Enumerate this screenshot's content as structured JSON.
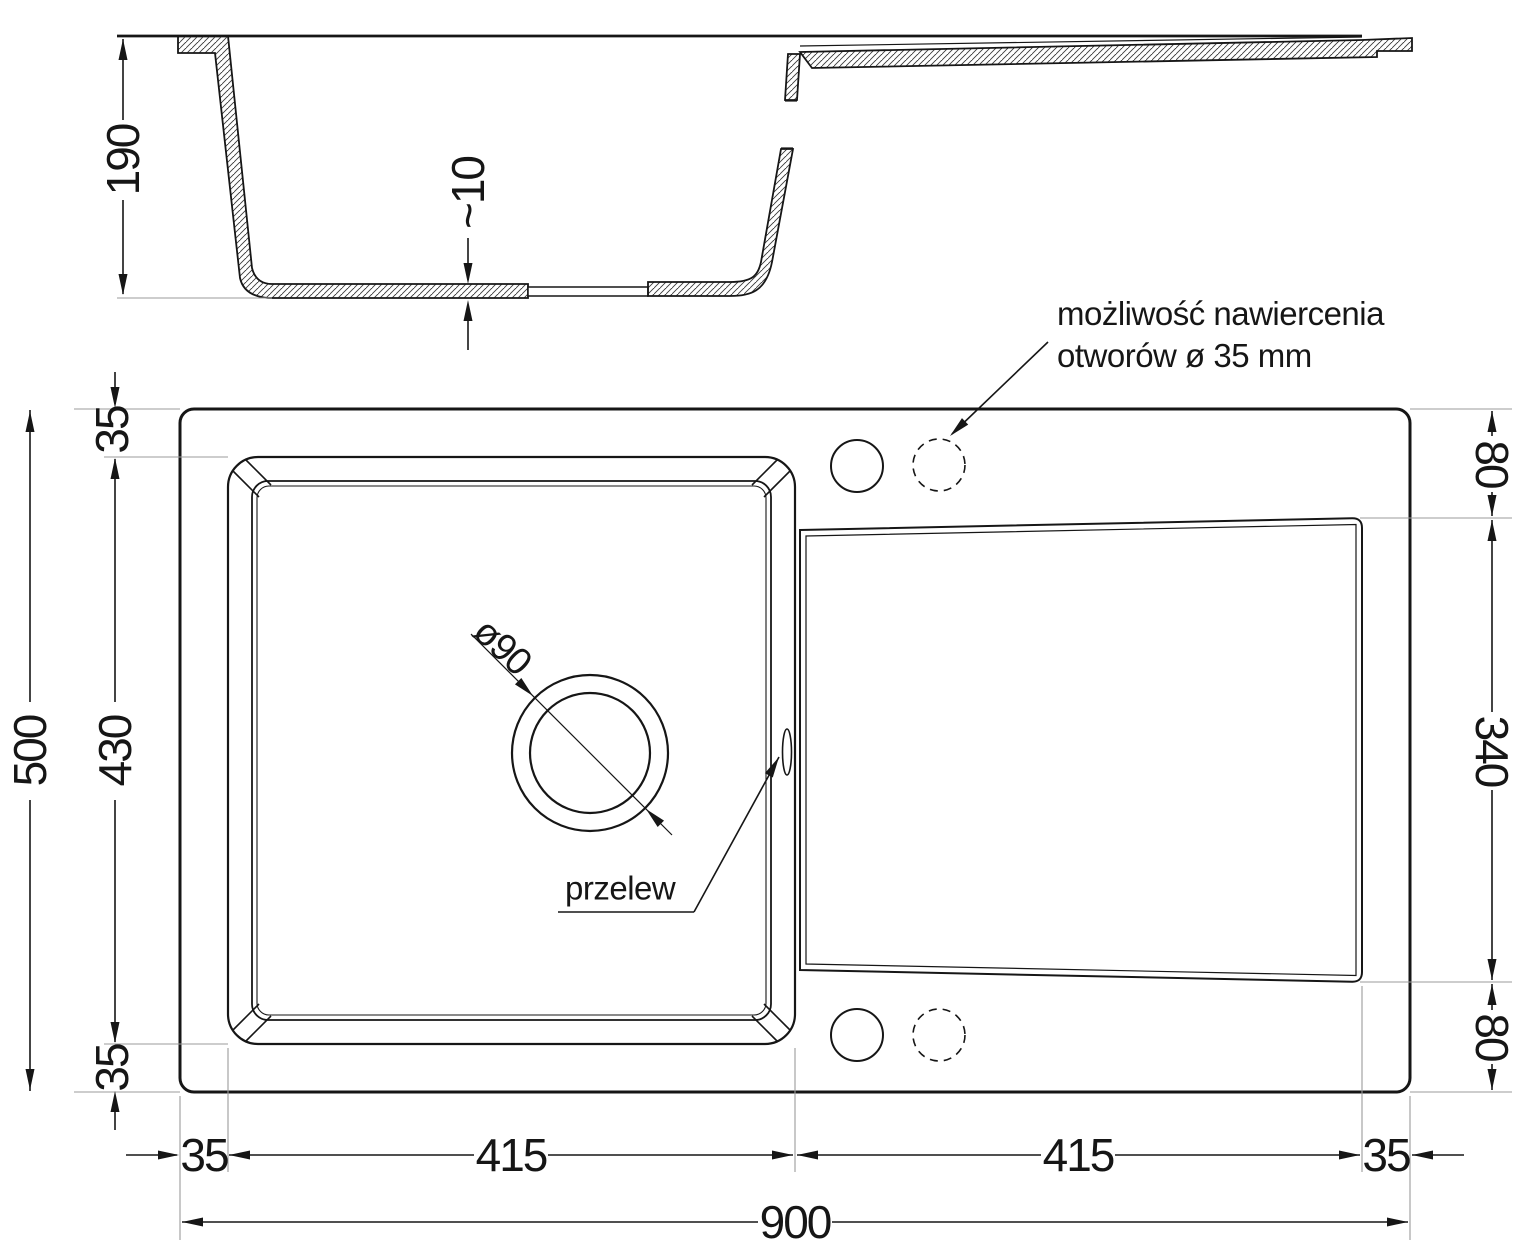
{
  "drawing": {
    "type": "sink-technical-drawing",
    "units": "mm",
    "dims": {
      "section_depth": "190",
      "section_bottom_thickness": "~10",
      "plan_total_depth": "500",
      "plan_rim_top": "35",
      "plan_bowl_depth": "430",
      "plan_rim_bottom": "35",
      "drainer_offset_top": "80",
      "drainer_height": "340",
      "drainer_offset_bottom": "80",
      "plan_margin_left": "35",
      "plan_bowl_width": "415",
      "plan_drainer_width": "415",
      "plan_margin_right": "35",
      "plan_total_width": "900",
      "drain_diameter": "ø90"
    },
    "labels": {
      "drill_note_line1": "możliwość nawiercenia",
      "drill_note_line2": "otworów ø 35 mm",
      "overflow": "przelew"
    },
    "colors": {
      "line": "#161616",
      "extension_line": "#9b9b9b",
      "background": "#ffffff"
    }
  }
}
